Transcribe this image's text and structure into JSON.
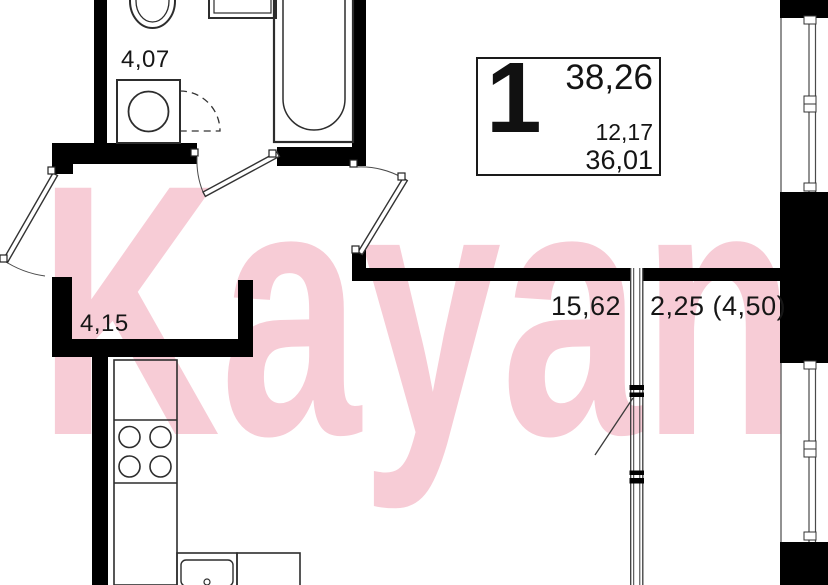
{
  "watermark": {
    "text": "Kayan",
    "color": "#f7ccd6"
  },
  "info_box": {
    "rooms_count": "1",
    "total_area": "38,26",
    "living_area": "12,17",
    "area_without_balcony": "36,01"
  },
  "rooms": {
    "bathroom": {
      "area": "4,07"
    },
    "hallway": {
      "area": "4,15"
    },
    "kitchen_living_room": {
      "area": "15,62"
    },
    "balcony": {
      "area": "2,25 (4,50)"
    }
  },
  "colors": {
    "wall": "#000000",
    "fixture_line": "#2d2d2d",
    "thin_line": "#4a4a4a",
    "text": "#161616",
    "background": "#ffffff",
    "watermark": "#f7ccd6"
  }
}
